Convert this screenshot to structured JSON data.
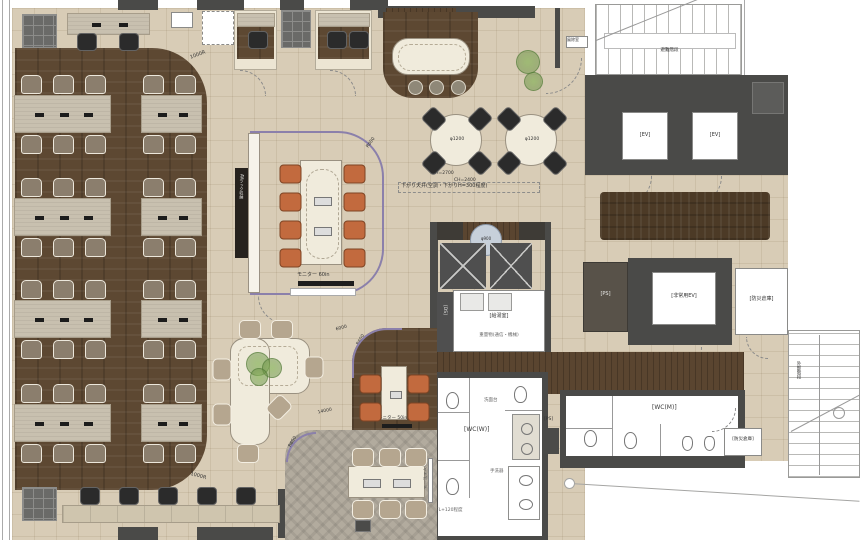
{
  "plan": {
    "title": "オフィス平面レイアウト図",
    "labels": {
      "ev1": "[EV]",
      "ev2": "[EV]",
      "emergency_ev": "[非常用EV]",
      "storage1": "[防災倉庫]",
      "storage2": "[防災倉庫]",
      "ps1": "[PS]",
      "ps2": "[PS]",
      "ds": "[DS]",
      "kitchenette": "[給湯室]",
      "wc_w": "[WC(W)]",
      "wc_m": "[WC(M)]",
      "monitor60": "モニター 60in",
      "monitor50": "モニター 50in",
      "whiteboard": "ホワイトボード",
      "table1200a": "φ1200",
      "table1200b": "φ1200",
      "table900": "φ900",
      "stair_top": "避難階段",
      "stair_right": "外部階段",
      "ev_hall": "EVホール(アプローチ)",
      "ceiling_note": "下がり天井(空調・下がりH=300程度)",
      "ch_a": "CH=2700",
      "ch_b": "CH=2400",
      "r600a": "R600",
      "r600b": "R600",
      "r650": "R650",
      "r1000a": "1000R",
      "r1000b": "1000R",
      "dim14000": "14000",
      "dim6000": "6000",
      "heavy_note": "重量物(通信・機械)",
      "fl_note": "FL+120程度",
      "sink": "洗面台",
      "hand_basin": "手洗器",
      "av_rack": "AVラック収納",
      "wind_lobby": "風除室"
    }
  }
}
